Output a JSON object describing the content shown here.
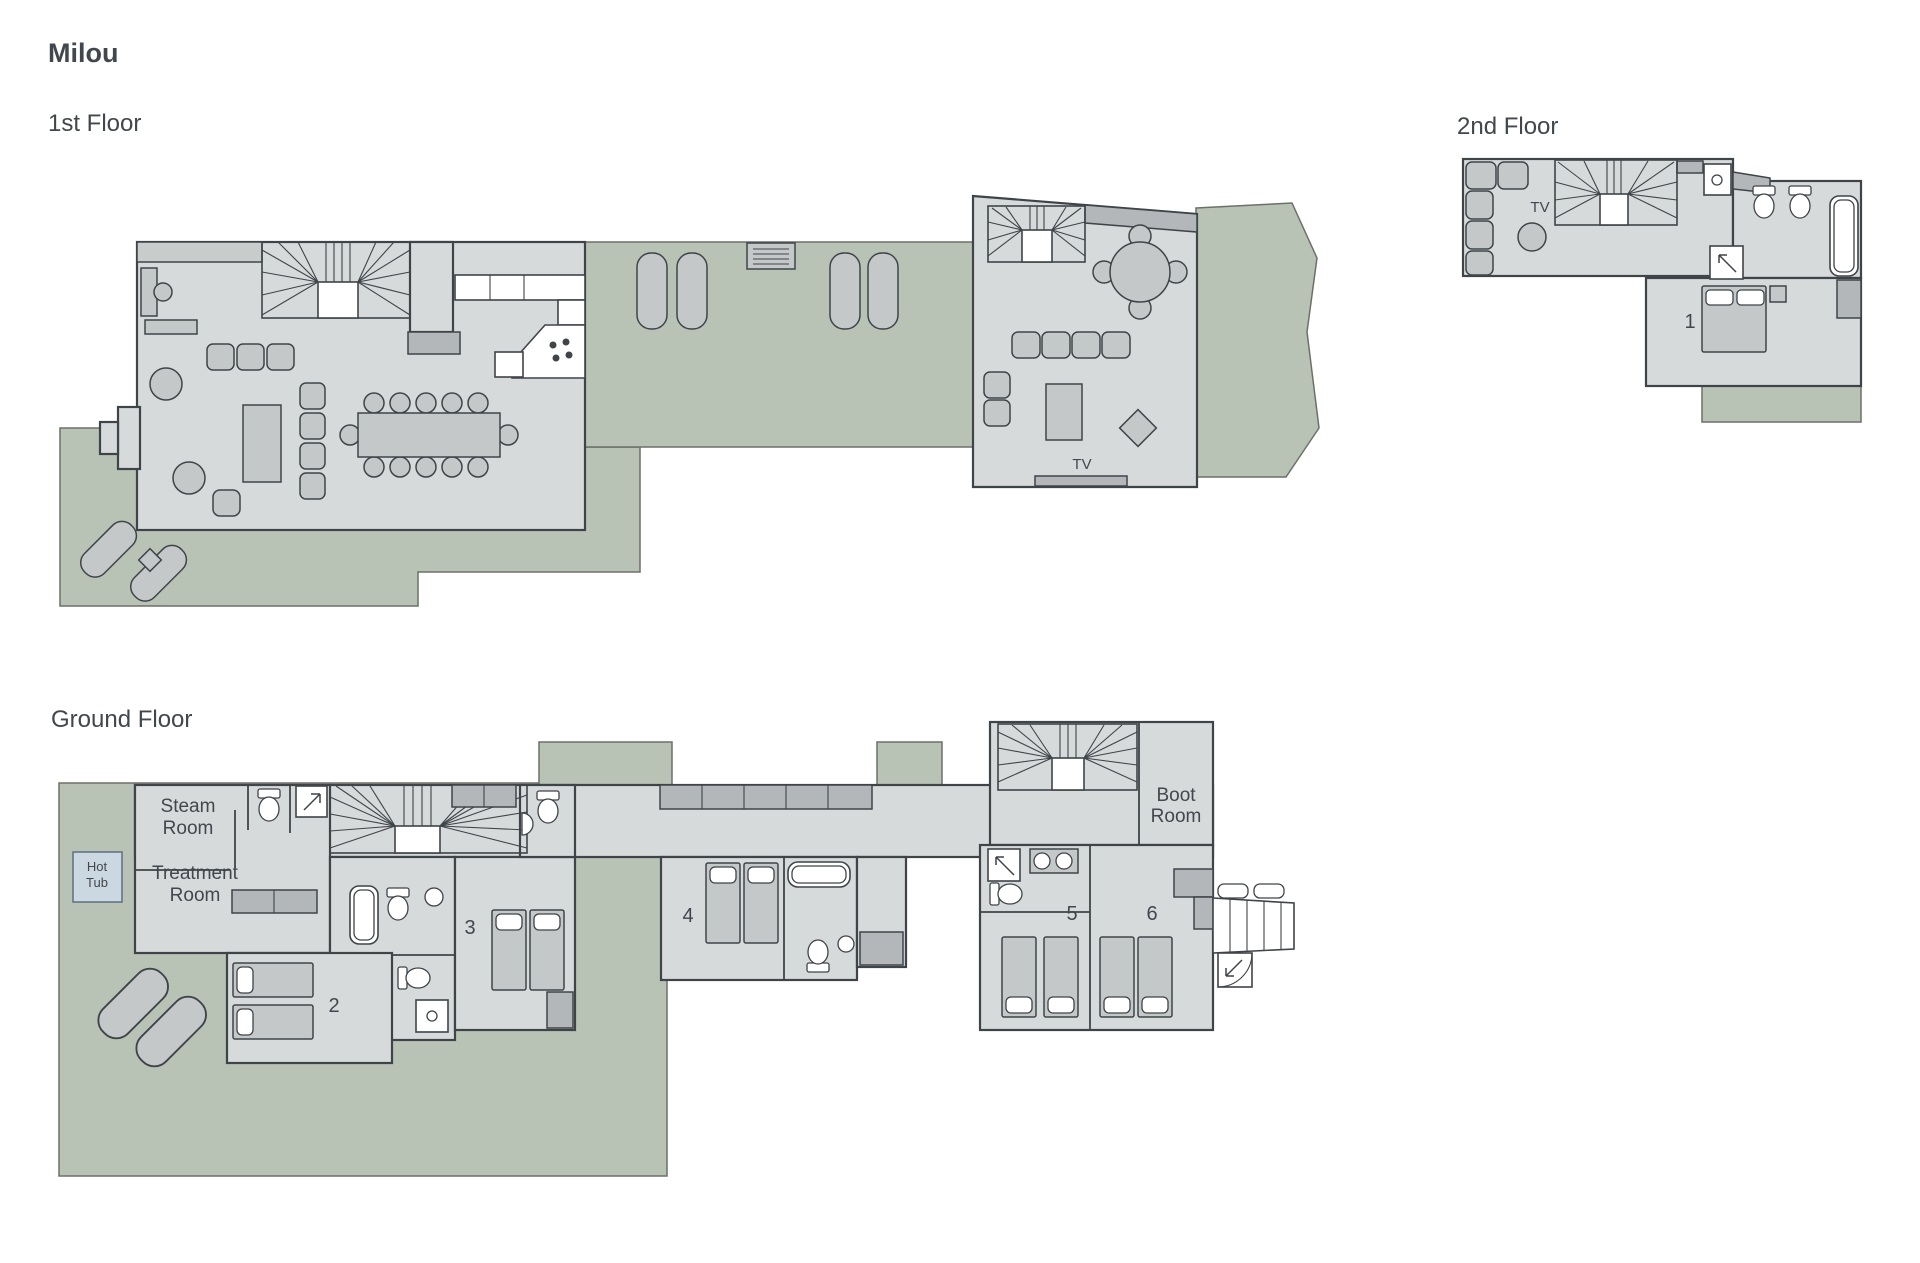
{
  "page_title": "Milou",
  "colors": {
    "background": "#ffffff",
    "floor": "#d7dadb",
    "wall": "#3f4449",
    "wall_strip": "#c8cccb",
    "terrace": "#b8c2b5",
    "terrace_edge": "#6b7168",
    "furniture": "#c4c8c9",
    "furniture_dark": "#b3b7b9",
    "fixture": "#ffffff",
    "hot_tub": "#ccd8e1",
    "hot_tub_edge": "#5d7081",
    "text": "#42474d"
  },
  "first_floor": {
    "label": "1st Floor",
    "tv_label": "TV"
  },
  "second_floor": {
    "label": "2nd Floor",
    "tv_label": "TV",
    "bedroom_number": "1"
  },
  "ground_floor": {
    "label": "Ground Floor",
    "steam_room": [
      "Steam",
      "Room"
    ],
    "treatment_room": [
      "Treatment",
      "Room"
    ],
    "hot_tub": [
      "Hot",
      "Tub"
    ],
    "boot_room": [
      "Boot",
      "Room"
    ],
    "bedroom_numbers": {
      "room2": "2",
      "room3": "3",
      "room4": "4",
      "room5": "5",
      "room6": "6"
    }
  }
}
